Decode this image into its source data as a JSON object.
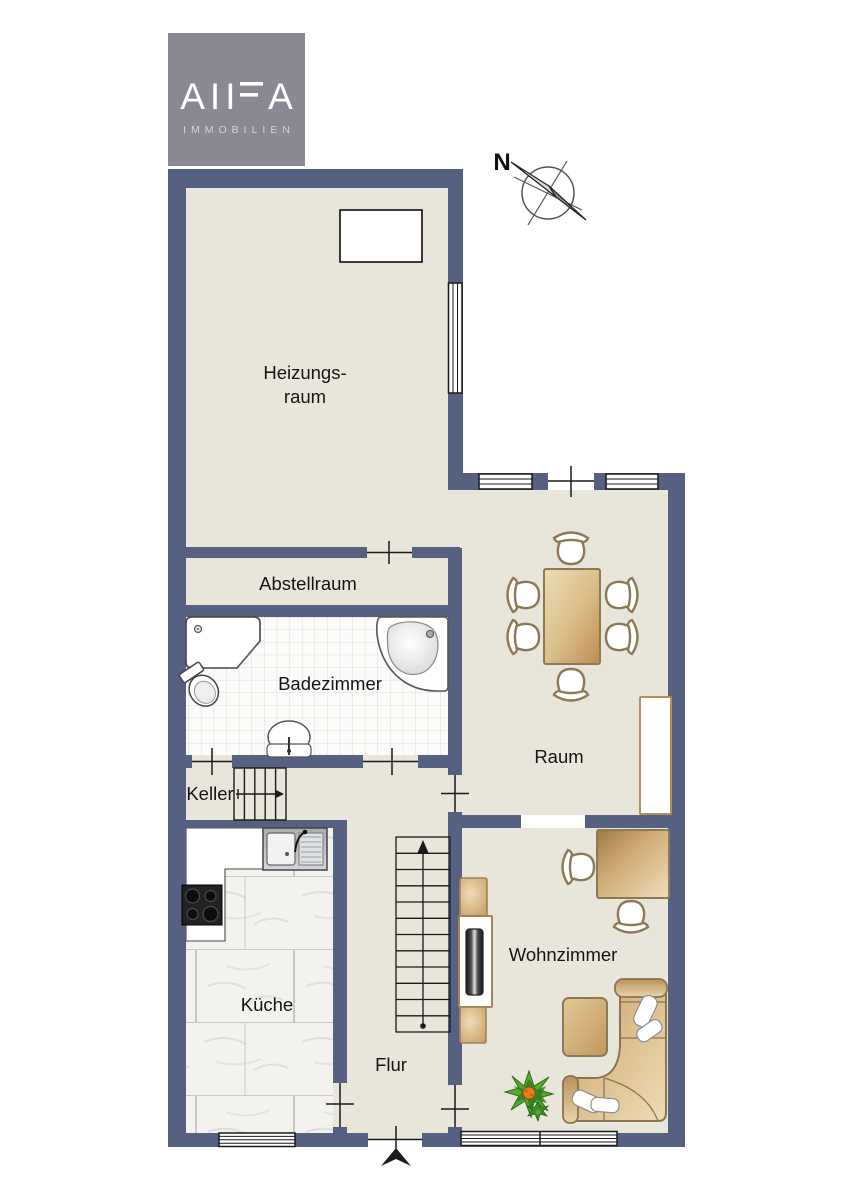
{
  "logo": {
    "letters": [
      "A",
      "I",
      "I",
      "F",
      "A"
    ],
    "subtitle": "IMMOBILIEN",
    "bg_color": "#8a8893",
    "text_color": "#ffffff"
  },
  "compass": {
    "north_label": "N"
  },
  "rooms": {
    "heizungsraum_line1": "Heizungs-",
    "heizungsraum_line2": "raum",
    "abstellraum": "Abstellraum",
    "badezimmer": "Badezimmer",
    "keller": "Keller",
    "kueche": "Küche",
    "flur": "Flur",
    "raum": "Raum",
    "wohnzimmer": "Wohnzimmer"
  },
  "palette": {
    "wall": "#566080",
    "floor_beige": "#e8e5db",
    "bath_tile": "#fbfbfa",
    "kitchen_tile": "#f3f2ee",
    "furniture_tan": "#d9b98c",
    "furniture_outline": "#8d7a55",
    "plant_green": "#57a832",
    "plant_center": "#e87d1c",
    "line_black": "#1a1a1a"
  }
}
